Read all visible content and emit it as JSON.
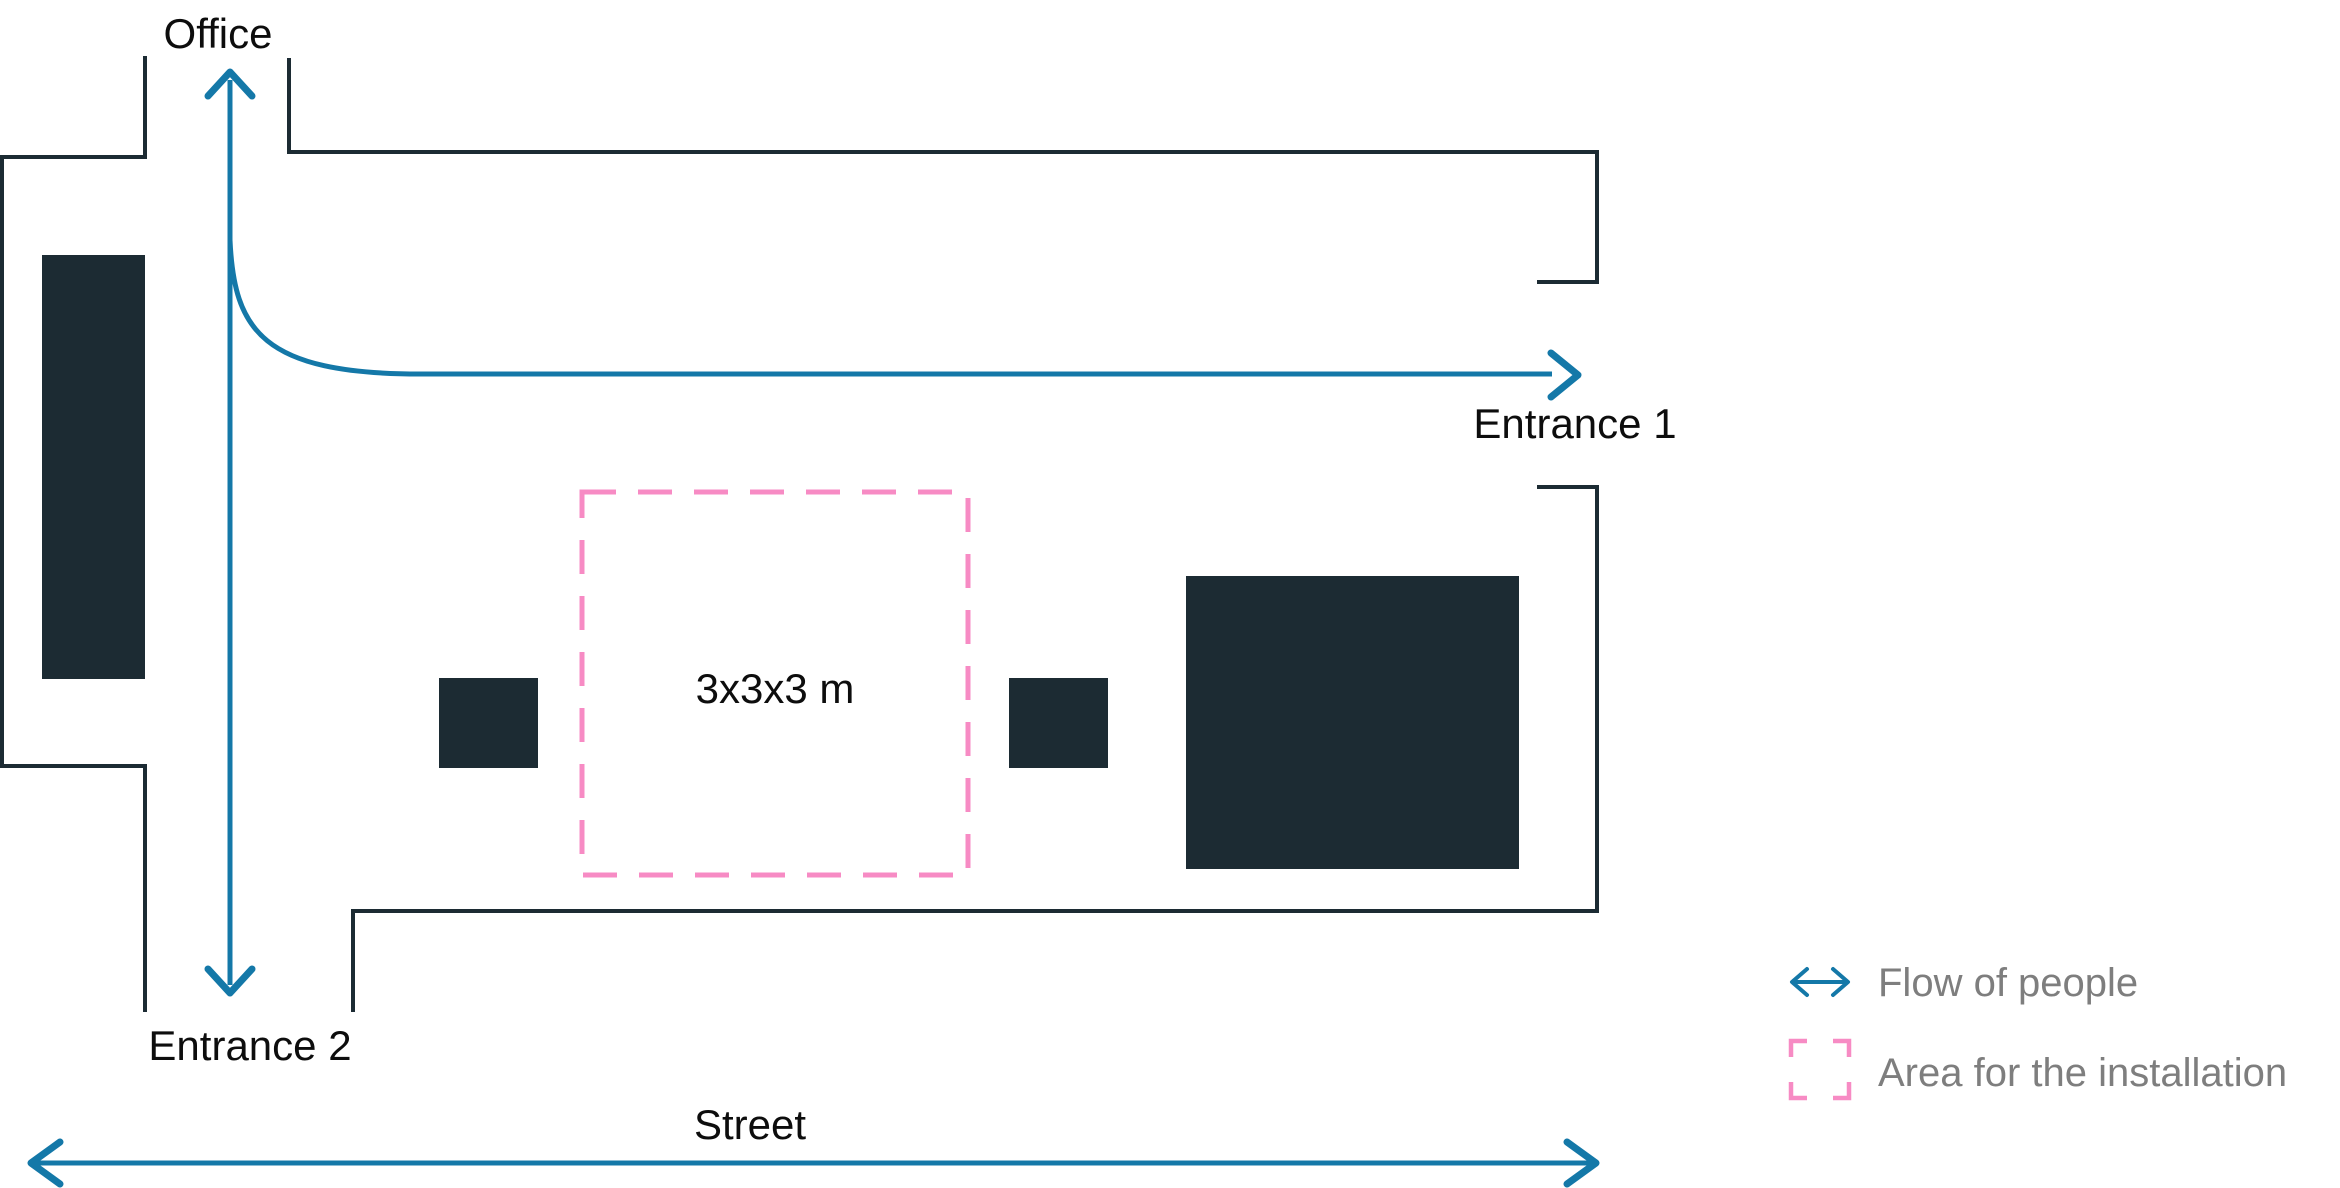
{
  "labels": {
    "office": "Office",
    "entrance_1": "Entrance 1",
    "entrance_2": "Entrance 2",
    "installation_size": "3x3x3 m",
    "street": "Street"
  },
  "legend": {
    "items": [
      {
        "icon": "double-arrow-icon",
        "label": "Flow of people"
      },
      {
        "icon": "dashed-square-icon",
        "label": "Area for the installation"
      }
    ]
  },
  "colors": {
    "background": "#FFFFFF",
    "wall": "#1C2B33",
    "flow_arrow": "#1478A8",
    "installation_area": "#F78BC4",
    "label_text": "#0D0D0D",
    "legend_text": "#7E7E7E"
  }
}
